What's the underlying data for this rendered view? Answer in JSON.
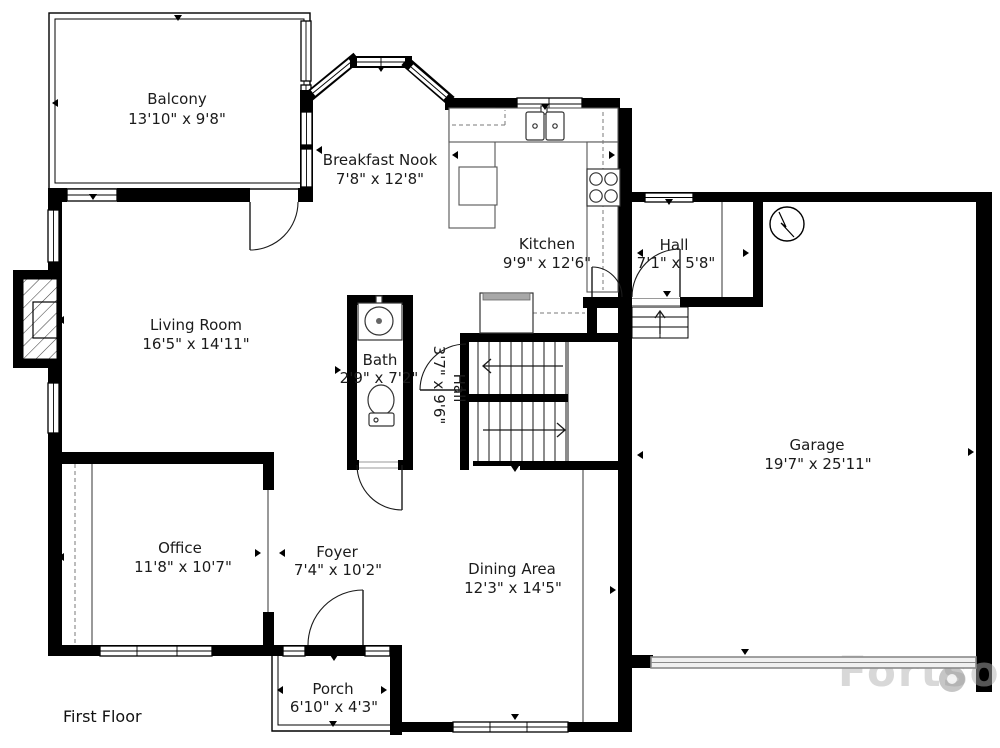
{
  "plan": {
    "floor_label": "First Floor",
    "watermark": "Fortso",
    "rooms": {
      "balcony": {
        "name": "Balcony",
        "dims": "13'10\" x 9'8\""
      },
      "breakfast_nook": {
        "name": "Breakfast Nook",
        "dims": "7'8\" x 12'8\""
      },
      "kitchen": {
        "name": "Kitchen",
        "dims": "9'9\" x 12'6\""
      },
      "hall_upper": {
        "name": "Hall",
        "dims": "7'1\" x 5'8\""
      },
      "living_room": {
        "name": "Living Room",
        "dims": "16'5\" x 14'11\""
      },
      "bath": {
        "name": "Bath",
        "dims": "2'9\" x 7'2\""
      },
      "hall_stairs": {
        "name": "Hall",
        "dims": "3'7\" x 9'6\""
      },
      "garage": {
        "name": "Garage",
        "dims": "19'7\" x 25'11\""
      },
      "office": {
        "name": "Office",
        "dims": "11'8\" x 10'7\""
      },
      "foyer": {
        "name": "Foyer",
        "dims": "7'4\" x 10'2\""
      },
      "dining_area": {
        "name": "Dining Area",
        "dims": "12'3\" x 14'5\""
      },
      "porch": {
        "name": "Porch",
        "dims": "6'10\" x 4'3\""
      }
    },
    "colors": {
      "wall": "#000000",
      "background": "#ffffff",
      "garage_door": "#8a8a8a",
      "watermark": "#b0b0b0"
    }
  }
}
